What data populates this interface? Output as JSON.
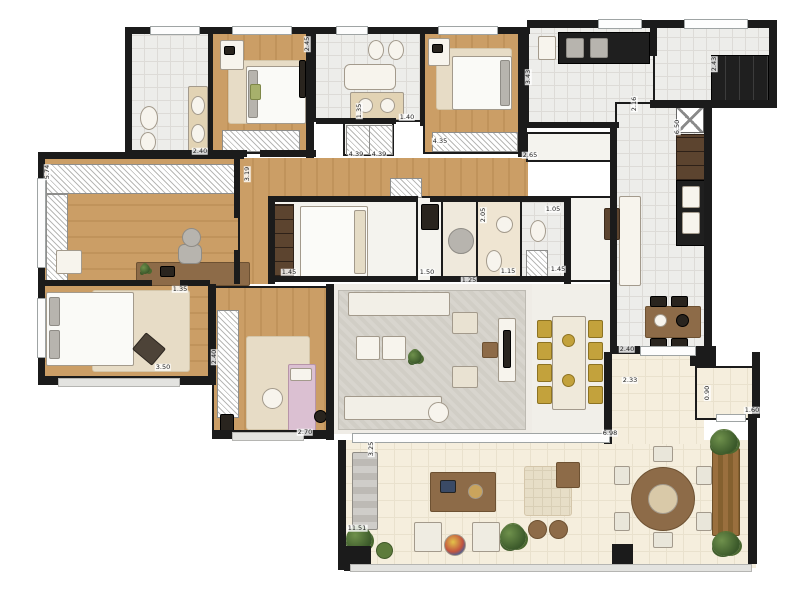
{
  "title": "apartment-floor-plan",
  "colors": {
    "wall": "#1b1b1b",
    "wood_floor": "#cb9e66",
    "tile_floor": "#ededea",
    "terrace_floor": "#f5eedd",
    "rug_gray": "#d8d5ce",
    "rug_beige": "#e7dcc6",
    "counter_black": "#1f1f1f",
    "cabinet_brown": "#5c442f",
    "table_brown": "#8d6b48",
    "chair_gold": "#c3a23c",
    "plant_green": "#44632f",
    "bed_white": "#fafaf7",
    "pink_accent": "#dbc0d2",
    "window_gray": "#9fa4a4"
  },
  "dimension_labels": [
    {
      "text": "2.40",
      "x": 200,
      "y": 151,
      "v": false
    },
    {
      "text": "2.45",
      "x": 307,
      "y": 44,
      "v": true
    },
    {
      "text": "1.35",
      "x": 359,
      "y": 111,
      "v": true
    },
    {
      "text": "4.39",
      "x": 356,
      "y": 154,
      "v": false
    },
    {
      "text": "4.39",
      "x": 379,
      "y": 154,
      "v": false
    },
    {
      "text": "1.40",
      "x": 407,
      "y": 117,
      "v": false
    },
    {
      "text": "4.35",
      "x": 440,
      "y": 141,
      "v": false
    },
    {
      "text": "3.43",
      "x": 528,
      "y": 77,
      "v": true
    },
    {
      "text": "2.43",
      "x": 714,
      "y": 64,
      "v": true
    },
    {
      "text": "2.16",
      "x": 634,
      "y": 104,
      "v": true
    },
    {
      "text": "6.50",
      "x": 677,
      "y": 127,
      "v": true
    },
    {
      "text": "2.65",
      "x": 530,
      "y": 155,
      "v": false
    },
    {
      "text": "1.05",
      "x": 553,
      "y": 209,
      "v": false
    },
    {
      "text": "2.05",
      "x": 483,
      "y": 215,
      "v": true
    },
    {
      "text": "1.50",
      "x": 427,
      "y": 272,
      "v": false
    },
    {
      "text": "1.15",
      "x": 508,
      "y": 271,
      "v": false
    },
    {
      "text": "1.25",
      "x": 469,
      "y": 280,
      "v": false
    },
    {
      "text": "1.45",
      "x": 558,
      "y": 269,
      "v": false
    },
    {
      "text": "1.45",
      "x": 289,
      "y": 272,
      "v": false
    },
    {
      "text": "1.35",
      "x": 180,
      "y": 289,
      "v": false
    },
    {
      "text": "2.40",
      "x": 214,
      "y": 357,
      "v": true
    },
    {
      "text": "3.50",
      "x": 163,
      "y": 367,
      "v": false
    },
    {
      "text": "2.70",
      "x": 305,
      "y": 432,
      "v": false
    },
    {
      "text": "3.25",
      "x": 371,
      "y": 449,
      "v": true
    },
    {
      "text": "11.51",
      "x": 357,
      "y": 528,
      "v": false
    },
    {
      "text": "6.98",
      "x": 610,
      "y": 433,
      "v": false
    },
    {
      "text": "2.40",
      "x": 627,
      "y": 349,
      "v": false
    },
    {
      "text": "2.33",
      "x": 630,
      "y": 380,
      "v": false
    },
    {
      "text": "0.90",
      "x": 707,
      "y": 393,
      "v": true
    },
    {
      "text": "1.60",
      "x": 752,
      "y": 410,
      "v": false
    },
    {
      "text": "5.74",
      "x": 47,
      "y": 172,
      "v": true
    },
    {
      "text": "3.19",
      "x": 247,
      "y": 174,
      "v": true
    }
  ]
}
